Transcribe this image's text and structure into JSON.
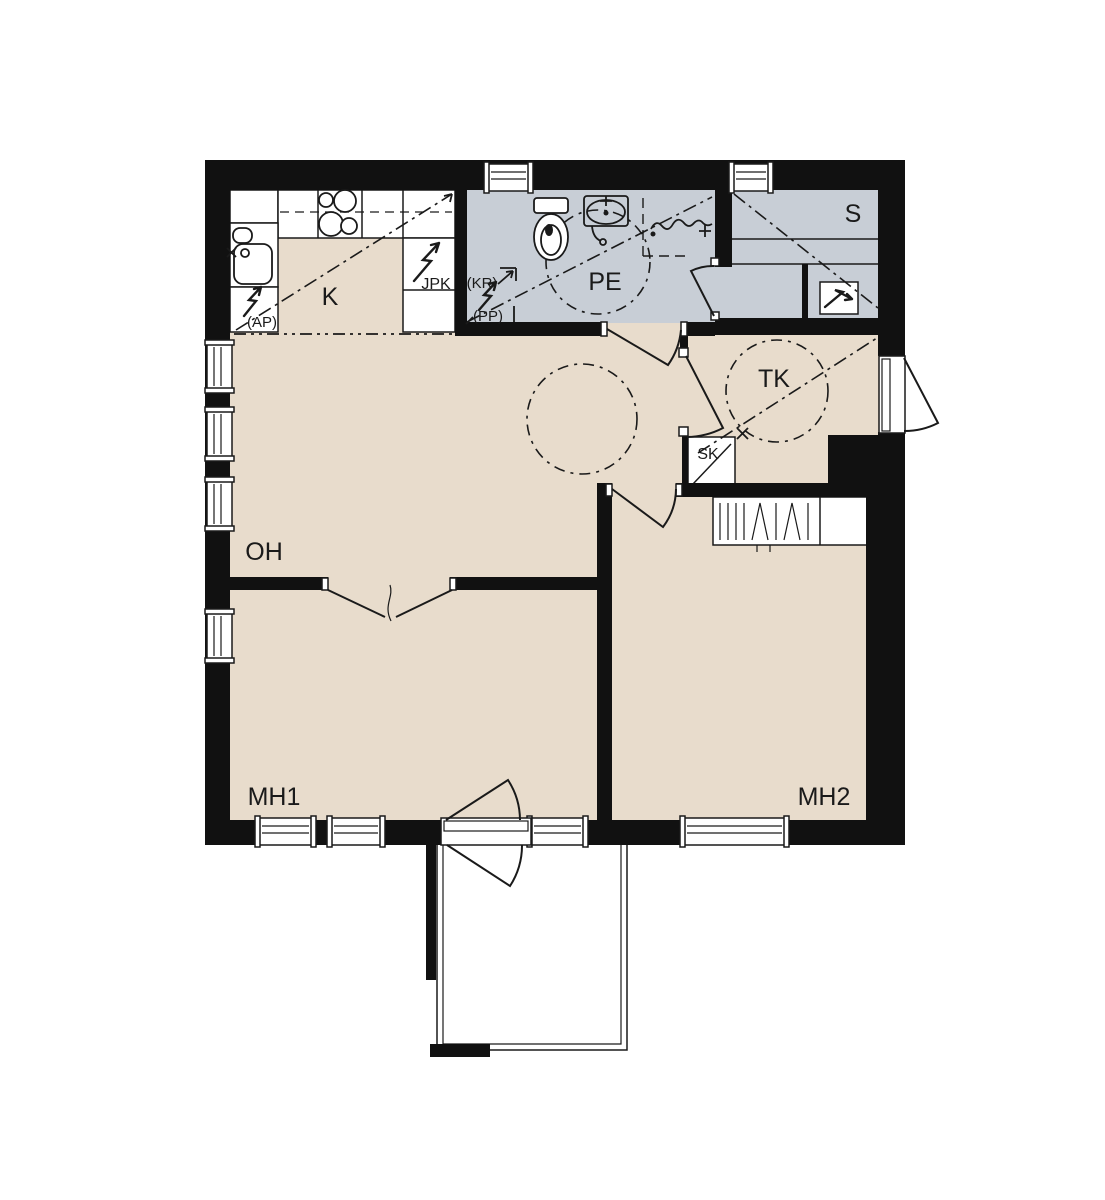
{
  "title": "apartment-floor-plan",
  "colors": {
    "wall": "#111111",
    "floor_dry": "#e8dccc",
    "floor_wet": "#c8ced6",
    "line": "#1a1a1a",
    "background": "#ffffff"
  },
  "rooms": {
    "kitchen": "K",
    "washroom": "PE",
    "sauna": "S",
    "vestibule": "TK",
    "cleaning_closet": "SK",
    "living_room": "OH",
    "bedroom_1": "MH1",
    "bedroom_2": "MH2"
  },
  "appliances": {
    "fridge_freezer": "JPK",
    "dryer_reservation": "(KR)",
    "washer_reservation": "(PP)",
    "dishwasher_reservation": "(AP)"
  }
}
